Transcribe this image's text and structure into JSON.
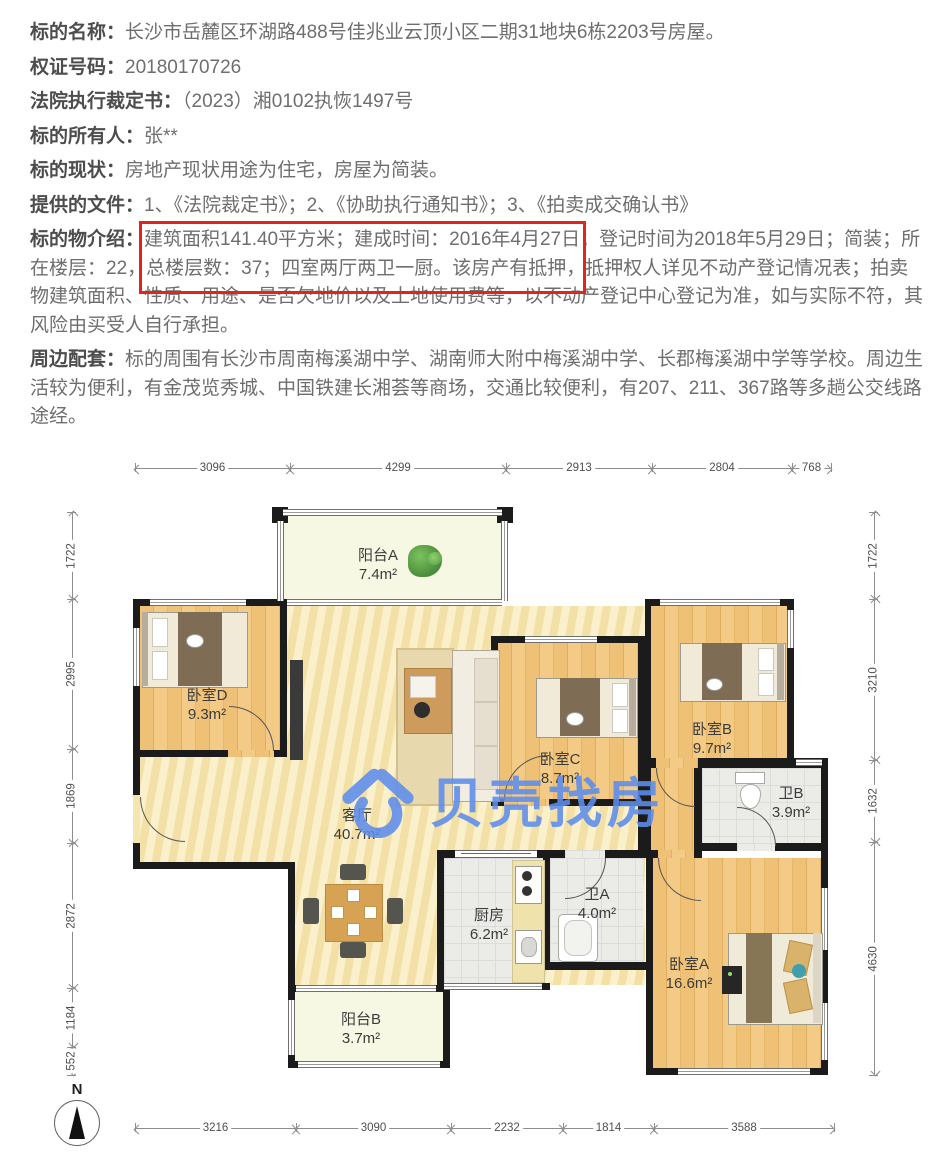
{
  "listing": {
    "highlight_color": "#e0261c",
    "fields": [
      {
        "label": "标的名称：",
        "value": "长沙市岳麓区环湖路488号佳兆业云顶小区二期31地块6栋2203号房屋。"
      },
      {
        "label": "权证号码：",
        "value": "20180170726"
      },
      {
        "label": "法院执行裁定书：",
        "value": "（2023）湘0102执恢1497号"
      },
      {
        "label": "标的所有人：",
        "value": "张**"
      },
      {
        "label": "标的现状：",
        "value": "房地产现状用途为住宅，房屋为简装。"
      },
      {
        "label": "提供的文件：",
        "value": "1、《法院裁定书》；2、《协助执行通知书》；3、《拍卖成交确认书》"
      },
      {
        "label": "标的物介绍：",
        "value": "建筑面积141.40平方米；建成时间：2016年4月27日；登记时间为2018年5月29日；简装；所在楼层：22，总楼层数：37；四室两厅两卫一厨。该房产有抵押，抵押权人详见不动产登记情况表；拍卖物建筑面积、性质、用途、是否欠地价以及土地使用费等，以不动产登记中心登记为准，如与实际不符，其风险由买受人自行承担。"
      },
      {
        "label": "周边配套：",
        "value": "标的周围有长沙市周南梅溪湖中学、湖南师大附中梅溪湖中学、长郡梅溪湖中学等学校。周边生活较为便利，有金茂览秀城、中国铁建长湘荟等商场，交通比较便利，有207、211、367路等多趟公交线路途经。"
      }
    ]
  },
  "floorplan": {
    "watermark": {
      "text": "贝壳找房",
      "color": "#5d8ded"
    },
    "compass_label": "N",
    "rooms": [
      {
        "name": "阳台A",
        "area": "7.4m²"
      },
      {
        "name": "卧室D",
        "area": "9.3m²"
      },
      {
        "name": "客厅",
        "area": "40.7m²"
      },
      {
        "name": "卧室C",
        "area": "8.7m²"
      },
      {
        "name": "卧室B",
        "area": "9.7m²"
      },
      {
        "name": "卫B",
        "area": "3.9m²"
      },
      {
        "name": "厨房",
        "area": "6.2m²"
      },
      {
        "name": "卫A",
        "area": "4.0m²"
      },
      {
        "name": "卧室A",
        "area": "16.6m²"
      },
      {
        "name": "阳台B",
        "area": "3.7m²"
      }
    ],
    "dims": {
      "top": [
        "3096",
        "4299",
        "2913",
        "2804",
        "768"
      ],
      "bottom": [
        "3216",
        "3090",
        "2232",
        "1814",
        "3588"
      ],
      "left": [
        "1722",
        "2995",
        "1869",
        "2872",
        "1184",
        "552"
      ],
      "right": [
        "1722",
        "3210",
        "1632",
        "4630"
      ]
    }
  }
}
